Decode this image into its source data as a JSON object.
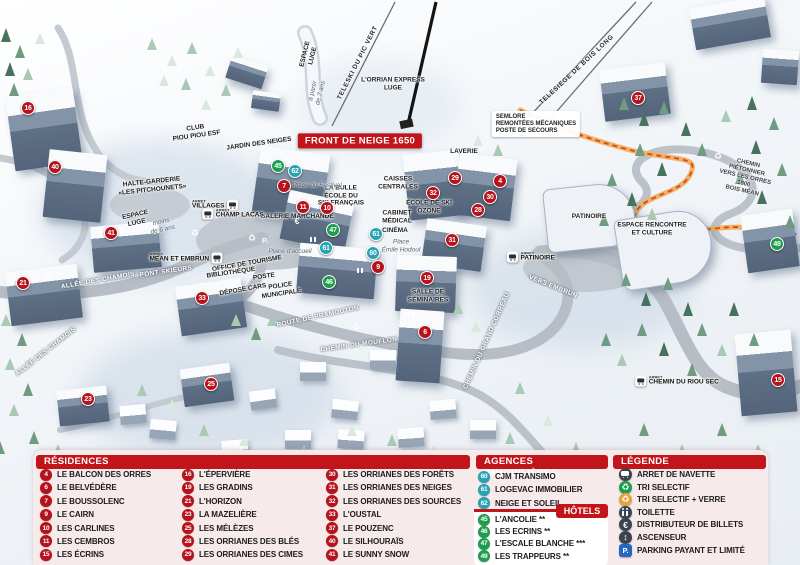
{
  "map": {
    "arret_label": "ARRET",
    "colors": {
      "residence": "#b5121c",
      "hotel": "#1f9d4f",
      "agence": "#27a3b4",
      "header_red": "#c2151b",
      "path_orange": "#e8923c"
    },
    "markers": [
      {
        "n": "16",
        "c": "r",
        "x": 28,
        "y": 108
      },
      {
        "n": "40",
        "c": "r",
        "x": 55,
        "y": 167
      },
      {
        "n": "41",
        "c": "r",
        "x": 111,
        "y": 233
      },
      {
        "n": "21",
        "c": "r",
        "x": 23,
        "y": 283
      },
      {
        "n": "33",
        "c": "r",
        "x": 202,
        "y": 298
      },
      {
        "n": "23",
        "c": "r",
        "x": 88,
        "y": 399
      },
      {
        "n": "25",
        "c": "r",
        "x": 211,
        "y": 384
      },
      {
        "n": "45",
        "c": "g",
        "x": 278,
        "y": 166
      },
      {
        "n": "62",
        "c": "b",
        "x": 295,
        "y": 171
      },
      {
        "n": "7",
        "c": "r",
        "x": 284,
        "y": 186
      },
      {
        "n": "11",
        "c": "r",
        "x": 303,
        "y": 207
      },
      {
        "n": "10",
        "c": "r",
        "x": 327,
        "y": 208
      },
      {
        "n": "29",
        "c": "r",
        "x": 455,
        "y": 178
      },
      {
        "n": "4",
        "c": "r",
        "x": 500,
        "y": 181
      },
      {
        "n": "32",
        "c": "r",
        "x": 433,
        "y": 193
      },
      {
        "n": "30",
        "c": "r",
        "x": 490,
        "y": 197
      },
      {
        "n": "28",
        "c": "r",
        "x": 478,
        "y": 210
      },
      {
        "n": "31",
        "c": "r",
        "x": 452,
        "y": 240
      },
      {
        "n": "47",
        "c": "g",
        "x": 333,
        "y": 230
      },
      {
        "n": "61",
        "c": "b",
        "x": 326,
        "y": 248
      },
      {
        "n": "61",
        "c": "b",
        "x": 376,
        "y": 234
      },
      {
        "n": "60",
        "c": "b",
        "x": 373,
        "y": 253
      },
      {
        "n": "9",
        "c": "r",
        "x": 378,
        "y": 267
      },
      {
        "n": "46",
        "c": "g",
        "x": 329,
        "y": 282
      },
      {
        "n": "19",
        "c": "r",
        "x": 427,
        "y": 278
      },
      {
        "n": "6",
        "c": "r",
        "x": 425,
        "y": 332
      },
      {
        "n": "37",
        "c": "r",
        "x": 638,
        "y": 98
      },
      {
        "n": "49",
        "c": "g",
        "x": 777,
        "y": 244
      },
      {
        "n": "15",
        "c": "r",
        "x": 778,
        "y": 380
      }
    ],
    "bus_stops": [
      {
        "label": "VILLAGES",
        "x": 215,
        "y": 205,
        "dir": "l"
      },
      {
        "label": "CHAMP LACAS",
        "x": 233,
        "y": 214,
        "dir": "r"
      },
      {
        "label": "MEAN ET EMBRUN",
        "x": 186,
        "y": 258,
        "dir": "l"
      },
      {
        "label": "PATINOIRE",
        "x": 531,
        "y": 257,
        "dir": "r"
      },
      {
        "label": "CHEMIN DU RIOU SEC",
        "x": 677,
        "y": 381,
        "dir": "r"
      }
    ],
    "icons": [
      {
        "icon": "recycle",
        "x": 195,
        "y": 233
      },
      {
        "icon": "recycle",
        "x": 48,
        "y": 278
      },
      {
        "icon": "recycle",
        "x": 356,
        "y": 327
      },
      {
        "icon": "recycle",
        "x": 718,
        "y": 156
      },
      {
        "icon": "glass",
        "x": 252,
        "y": 238
      },
      {
        "icon": "parking",
        "x": 265,
        "y": 240
      },
      {
        "icon": "euro",
        "x": 297,
        "y": 221
      },
      {
        "icon": "wc",
        "x": 310,
        "y": 237
      },
      {
        "icon": "wc",
        "x": 357,
        "y": 268
      },
      {
        "icon": "wc",
        "x": 408,
        "y": 311
      }
    ],
    "labels": [
      {
        "t": "FRONT DE NEIGE 1650",
        "x": 360,
        "y": 141,
        "k": "banner"
      },
      {
        "t": "L'ORRIAN EXPRESS\nLUGE",
        "x": 393,
        "y": 84,
        "k": "fac"
      },
      {
        "t": "TELESKI DU PIC VERT",
        "x": 358,
        "y": 63,
        "rot": -63,
        "k": "lift"
      },
      {
        "t": "TELESIEGE DE BOIS LONG",
        "x": 577,
        "y": 70,
        "rot": -43,
        "k": "lift"
      },
      {
        "t": "SEMLORE\nREMONTÉES MÉCANIQUES\nPOSTE DE SECOURS",
        "x": 536,
        "y": 124,
        "k": "sign"
      },
      {
        "t": "LAVERIE",
        "x": 464,
        "y": 152,
        "k": "fac"
      },
      {
        "t": "CAISSES\nCENTRALES",
        "x": 398,
        "y": 183,
        "k": "fac"
      },
      {
        "t": "LA BULLE\nÉCOLE DU\nSKI FRANÇAIS",
        "x": 341,
        "y": 196,
        "k": "fac"
      },
      {
        "t": "ÉCOLE DE SKI\nOZONE",
        "x": 429,
        "y": 207,
        "k": "fac"
      },
      {
        "t": "GALERIE MARCHANDE",
        "x": 297,
        "y": 217,
        "k": "fac"
      },
      {
        "t": "CABINET\nMÉDICAL",
        "x": 397,
        "y": 217,
        "k": "fac"
      },
      {
        "t": "CINÉMA",
        "x": 395,
        "y": 231,
        "k": "fac"
      },
      {
        "t": "CLUB\nPIOU PIOU ESF",
        "x": 196,
        "y": 132,
        "rot": -8,
        "k": "fac"
      },
      {
        "t": "JARDIN DES NEIGES",
        "x": 259,
        "y": 144,
        "rot": -8,
        "k": "fac"
      },
      {
        "t": "HALTE-GARDERIE\n«LES PITCHOUNETS»",
        "x": 152,
        "y": 186,
        "rot": -6,
        "k": "fac"
      },
      {
        "t": "ESPACE\nLUGE",
        "x": 136,
        "y": 219,
        "rot": -12,
        "k": "fac"
      },
      {
        "t": "moins\nde 6 ans",
        "x": 162,
        "y": 226,
        "rot": -12,
        "k": "place"
      },
      {
        "t": "ESPACE\nLUGE",
        "x": 309,
        "y": 55,
        "rot": -76,
        "k": "fac"
      },
      {
        "t": "à partir\nde 7 ans",
        "x": 317,
        "y": 92,
        "rot": -76,
        "k": "place"
      },
      {
        "t": "Place du Festival",
        "x": 317,
        "y": 186,
        "k": "place"
      },
      {
        "t": "Place d'accueil",
        "x": 290,
        "y": 252,
        "k": "place"
      },
      {
        "t": "Place\nÉmile Hodoul",
        "x": 401,
        "y": 246,
        "k": "place"
      },
      {
        "t": "OFFICE DE TOURISME",
        "x": 247,
        "y": 264,
        "rot": -10,
        "k": "fac"
      },
      {
        "t": "BIBLIOTHÈQUE",
        "x": 231,
        "y": 273,
        "rot": -8,
        "k": "fac"
      },
      {
        "t": "POSTE",
        "x": 264,
        "y": 277,
        "rot": -8,
        "k": "fac"
      },
      {
        "t": "DÉPOSE CARS",
        "x": 243,
        "y": 290,
        "rot": -10,
        "k": "fac"
      },
      {
        "t": "POLICE\nMUNICIPALE",
        "x": 281,
        "y": 290,
        "rot": -8,
        "k": "fac"
      },
      {
        "t": "SALLE DE\nSÉMINAIRES",
        "x": 428,
        "y": 296,
        "k": "fac"
      },
      {
        "t": "PATINOIRE",
        "x": 589,
        "y": 217,
        "k": "fac"
      },
      {
        "t": "ESPACE RENCONTRE\nET CULTURE",
        "x": 652,
        "y": 229,
        "k": "fac"
      },
      {
        "t": "ALLÉE DES CHAMOIS",
        "x": 98,
        "y": 281,
        "rot": -10,
        "k": "street"
      },
      {
        "t": "ALLÉE DES CHAMOIS",
        "x": 46,
        "y": 352,
        "rot": -38,
        "k": "street"
      },
      {
        "t": "PONT SKIEURS",
        "x": 166,
        "y": 272,
        "rot": -8,
        "k": "street"
      },
      {
        "t": "ROUTE DE PRAMOUTON",
        "x": 318,
        "y": 317,
        "rot": -12,
        "k": "street"
      },
      {
        "t": "CHEMIN DU MOUFLON",
        "x": 359,
        "y": 345,
        "rot": -8,
        "k": "street"
      },
      {
        "t": "CHEMIN DU GRAND CORREAU",
        "x": 487,
        "y": 341,
        "rot": -66,
        "k": "street"
      },
      {
        "t": "VERS EMBRUN",
        "x": 553,
        "y": 287,
        "rot": 22,
        "k": "street"
      },
      {
        "t": "CHEMIN PIÉTONNIER\nVERS LES ORRES 1800\nBOIS MÉAN",
        "x": 745,
        "y": 178,
        "rot": 13,
        "k": "pathlbl"
      }
    ]
  },
  "panels": {
    "residences": {
      "title": "RÉSIDENCES",
      "cols": [
        [
          {
            "n": "4",
            "label": "LE BALCON DES ORRES"
          },
          {
            "n": "6",
            "label": "LE BELVÉDÈRE"
          },
          {
            "n": "7",
            "label": "LE BOUSSOLENC"
          },
          {
            "n": "9",
            "label": "LE CAIRN"
          },
          {
            "n": "10",
            "label": "LES CARLINES"
          },
          {
            "n": "11",
            "label": "LES CEMBROS"
          },
          {
            "n": "15",
            "label": "LES ÉCRINS"
          }
        ],
        [
          {
            "n": "16",
            "label": "L'ÉPERVIÈRE"
          },
          {
            "n": "19",
            "label": "LES GRADINS"
          },
          {
            "n": "21",
            "label": "L'HORIZON"
          },
          {
            "n": "23",
            "label": "LA MAZELIÈRE"
          },
          {
            "n": "25",
            "label": "LES MÉLÈZES"
          },
          {
            "n": "28",
            "label": "LES ORRIANES DES BLÉS"
          },
          {
            "n": "29",
            "label": "LES ORRIANES DES CIMES"
          }
        ],
        [
          {
            "n": "30",
            "label": "LES ORRIANES DES FORÊTS"
          },
          {
            "n": "31",
            "label": "LES ORRIANES DES NEIGES"
          },
          {
            "n": "32",
            "label": "LES ORRIANES DES SOURCES"
          },
          {
            "n": "33",
            "label": "L'OUSTAL"
          },
          {
            "n": "37",
            "label": "LE POUZENC"
          },
          {
            "n": "40",
            "label": "LE SILHOURAÏS"
          },
          {
            "n": "41",
            "label": "LE SUNNY SNOW"
          }
        ]
      ]
    },
    "agences": {
      "title": "AGENCES IMMOBILIÈRES",
      "items": [
        {
          "n": "60",
          "label": "CJM TRANSIMO"
        },
        {
          "n": "61",
          "label": "LOGEVAC IMMOBILIER"
        },
        {
          "n": "62",
          "label": "NEIGE ET SOLEIL"
        }
      ]
    },
    "hotels": {
      "title": "HÔTELS",
      "items": [
        {
          "n": "45",
          "label": "L'ANCOLIE **"
        },
        {
          "n": "46",
          "label": "LES ECRINS **"
        },
        {
          "n": "47",
          "label": "L'ESCALE BLANCHE ***"
        },
        {
          "n": "49",
          "label": "LES TRAPPEURS **"
        }
      ]
    },
    "legende": {
      "title": "LÉGENDE",
      "items": [
        {
          "icon": "bus",
          "label": "ARRET DE NAVETTE"
        },
        {
          "icon": "recycle",
          "label": "TRI SELECTIF"
        },
        {
          "icon": "glass",
          "label": "TRI SELECTIF + VERRE"
        },
        {
          "icon": "wc",
          "label": "TOILETTE"
        },
        {
          "icon": "euro",
          "label": "DISTRIBUTEUR DE BILLETS"
        },
        {
          "icon": "elevator",
          "label": "ASCENSEUR"
        },
        {
          "icon": "parking",
          "label": "PARKING PAYANT ET LIMITÉ"
        }
      ]
    }
  }
}
